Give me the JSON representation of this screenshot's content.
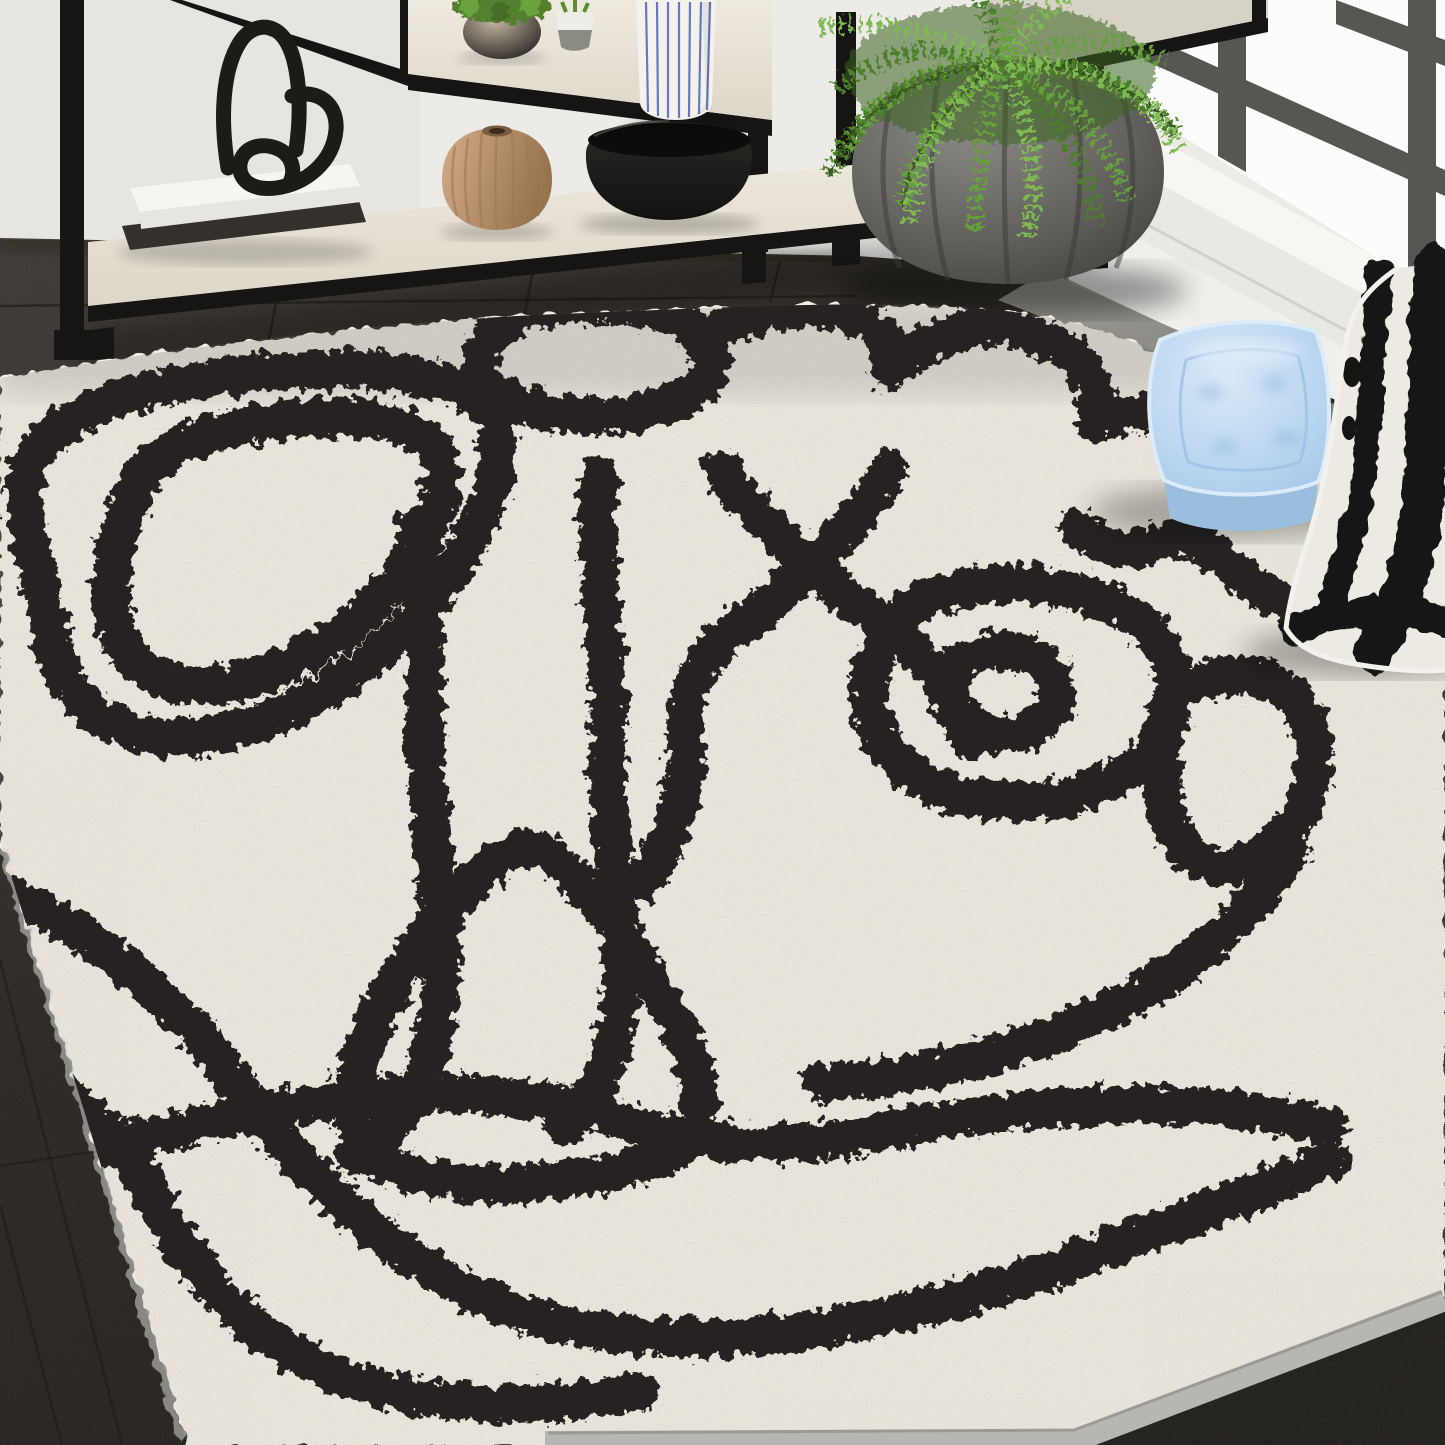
{
  "scene": {
    "kind": "interior photograph",
    "inventory": [
      "white wall",
      "black-framed window",
      "white window sill",
      "dark wood plank floor",
      "black metal etagere shelving unit",
      "stone shelf slabs",
      "black knot sculpture",
      "stack of books",
      "stone pot with green plant",
      "two-tone mini planter",
      "white vase with blue pinstripes",
      "ribbed tan vase",
      "black ceramic bowl",
      "boston fern",
      "gray pumpkin planter",
      "ivory shag area rug with black abstract line pattern",
      "gray rug binding",
      "light blue tufted floor cushion",
      "black and white striped throw pillow"
    ]
  },
  "palette": {
    "wall": "#ecebe8",
    "glass": "#fcfcfb",
    "mullion": "#575653",
    "sill_top": "#f7f6f2",
    "sill_face": "#e9e8e3",
    "under_sill_wall": "#f0efec",
    "floor_dark": "#282520",
    "floor_light_wedge": "#8b8985",
    "plank_seam": "#14120f",
    "metal_frame": "#161514",
    "slab_stone": "#e8e3d7",
    "book_white": "#f6f5f2",
    "book_dark": "#34302c",
    "sculpture_black": "#1d1b18",
    "stone_pot": "#b2a591",
    "foliage_green": "#527f2d",
    "pot_white": "#efede8",
    "pot_gray": "#8b8b84",
    "vase_white": "#f3f2ed",
    "vase_stripe_blue": "#5066b5",
    "ribbed_vase_tan": "#c4a07b",
    "bowl_black": "#1b1917",
    "bowl_opening": "#0d0c0b",
    "fern_dark": "#3c6423",
    "fern_pot_gray": "#77756f",
    "rug_ivory": "#f1ede3",
    "rug_line_black": "#262220",
    "rug_binding_gray": "#b7b6b0",
    "cushion_blue": "#b4d2ee",
    "cushion_blue_dark": "#9abede",
    "pillow_white": "#eceae3",
    "pillow_black": "#171512"
  }
}
